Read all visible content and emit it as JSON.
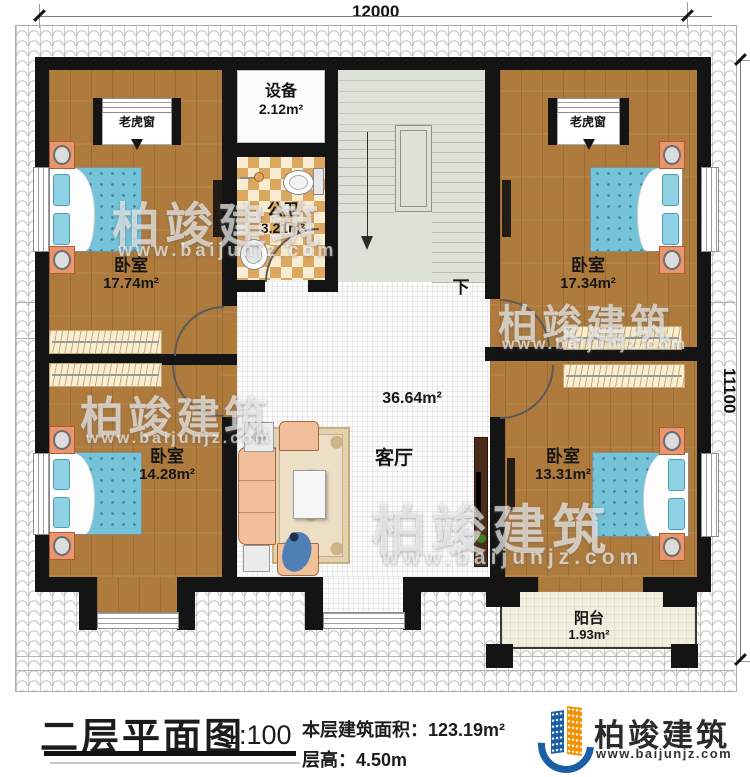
{
  "dimensions": {
    "width_top": "12000",
    "height_right": "11100"
  },
  "rooms": {
    "bedroom_tl": {
      "name": "卧室",
      "area": "17.74m²"
    },
    "bedroom_tr": {
      "name": "卧室",
      "area": "17.34m²"
    },
    "bedroom_bl": {
      "name": "卧室",
      "area": "14.28m²"
    },
    "bedroom_br": {
      "name": "卧室",
      "area": "13.31m²"
    },
    "living_room": {
      "name": "客厅",
      "area": "36.64m²"
    },
    "equipment": {
      "name": "设备",
      "area": "2.12m²"
    },
    "bathroom": {
      "name": "公卫",
      "area": "3.21m²"
    },
    "balcony": {
      "name": "阳台",
      "area": "1.93m²"
    }
  },
  "labels": {
    "dormer_window": "老虎窗",
    "stairs_down": "下"
  },
  "title_block": {
    "title": "二层平面图",
    "scale": "1:100",
    "floor_area_label": "本层建筑面积：123.19m²",
    "floor_height_label": "层高：4.50m"
  },
  "branding": {
    "company": "柏竣建筑",
    "website": "www.baijunjz.com"
  },
  "watermark": {
    "company": "柏竣建筑",
    "website": "www.baijunjz.com"
  },
  "colors": {
    "wall": "#141414",
    "wood_floor": "#ae7b3d",
    "bath_tile": "#dca75f",
    "stair_floor": "#dde2d8",
    "bed_blue": "#74c3d9",
    "nightstand": "#e9956d",
    "logo_blue": "#1b5ea6",
    "logo_orange": "#f29200"
  }
}
